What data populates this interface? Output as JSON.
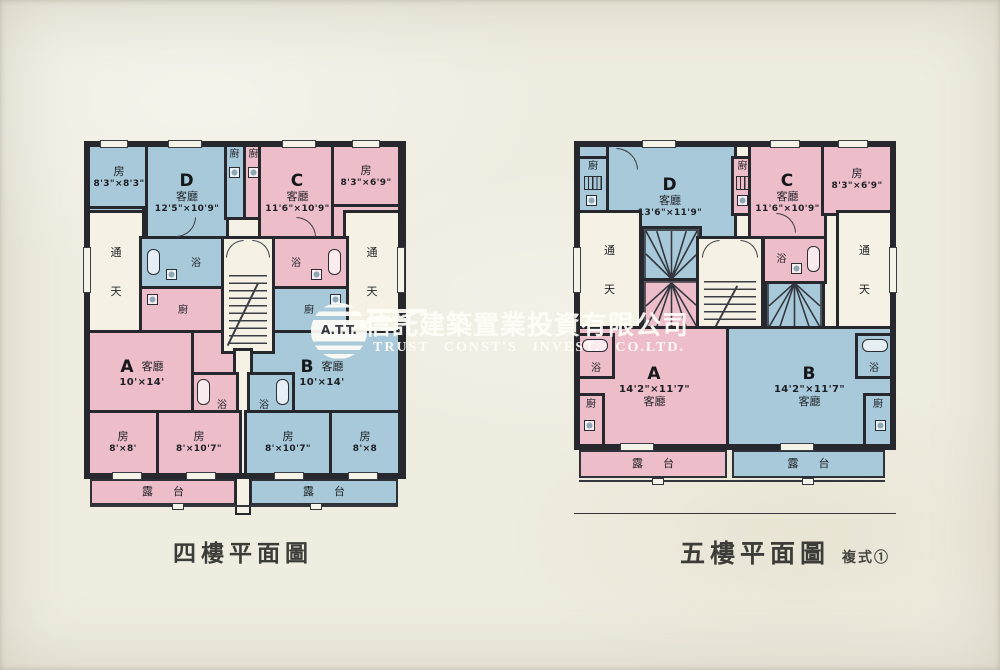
{
  "captions": {
    "left": "四樓平面圖",
    "right": "五樓平面圖",
    "right_note": "複式①"
  },
  "watermark": {
    "logo_text": "A.T.T.",
    "company_cn": "信託建築置業投資有限公司",
    "company_en": "TRUST CONST'S INVEST. CO.LTD."
  },
  "labels": {
    "bedroom": "房",
    "living": "客廳",
    "kitchen": "廚",
    "bath": "浴",
    "lightwell_top": "通",
    "lightwell_bottom": "天",
    "balcony": "露台"
  },
  "plan4": {
    "units": {
      "a": "A",
      "b": "B",
      "c": "C",
      "d": "D"
    },
    "dims": {
      "bed_tl": "8'3\"×8'3\"",
      "d_living": "12'5\"×10'9\"",
      "c_living": "11'6\"×10'9\"",
      "bed_tr": "8'3\"×6'9\"",
      "a_living": "10'×14'",
      "b_living": "10'×14'",
      "bed_a1": "8'×8'",
      "bed_a2": "8'×10'7\"",
      "bed_b1": "8'×10'7\"",
      "bed_b2": "8'×8"
    }
  },
  "plan5": {
    "units": {
      "a": "A",
      "b": "B",
      "c": "C",
      "d": "D"
    },
    "dims": {
      "d_living": "13'6\"×11'9\"",
      "c_living": "11'6\"×10'9\"",
      "bed_tr": "8'3\"×6'9\"",
      "a_living": "14'2\"×11'7\"",
      "b_living": "14'2\"×11'7\""
    }
  },
  "colors": {
    "blue": "#a7c9d9",
    "pink": "#edbdca",
    "wall": "#26282e",
    "paper": "#efece0",
    "room_white": "#f5f2e5"
  }
}
